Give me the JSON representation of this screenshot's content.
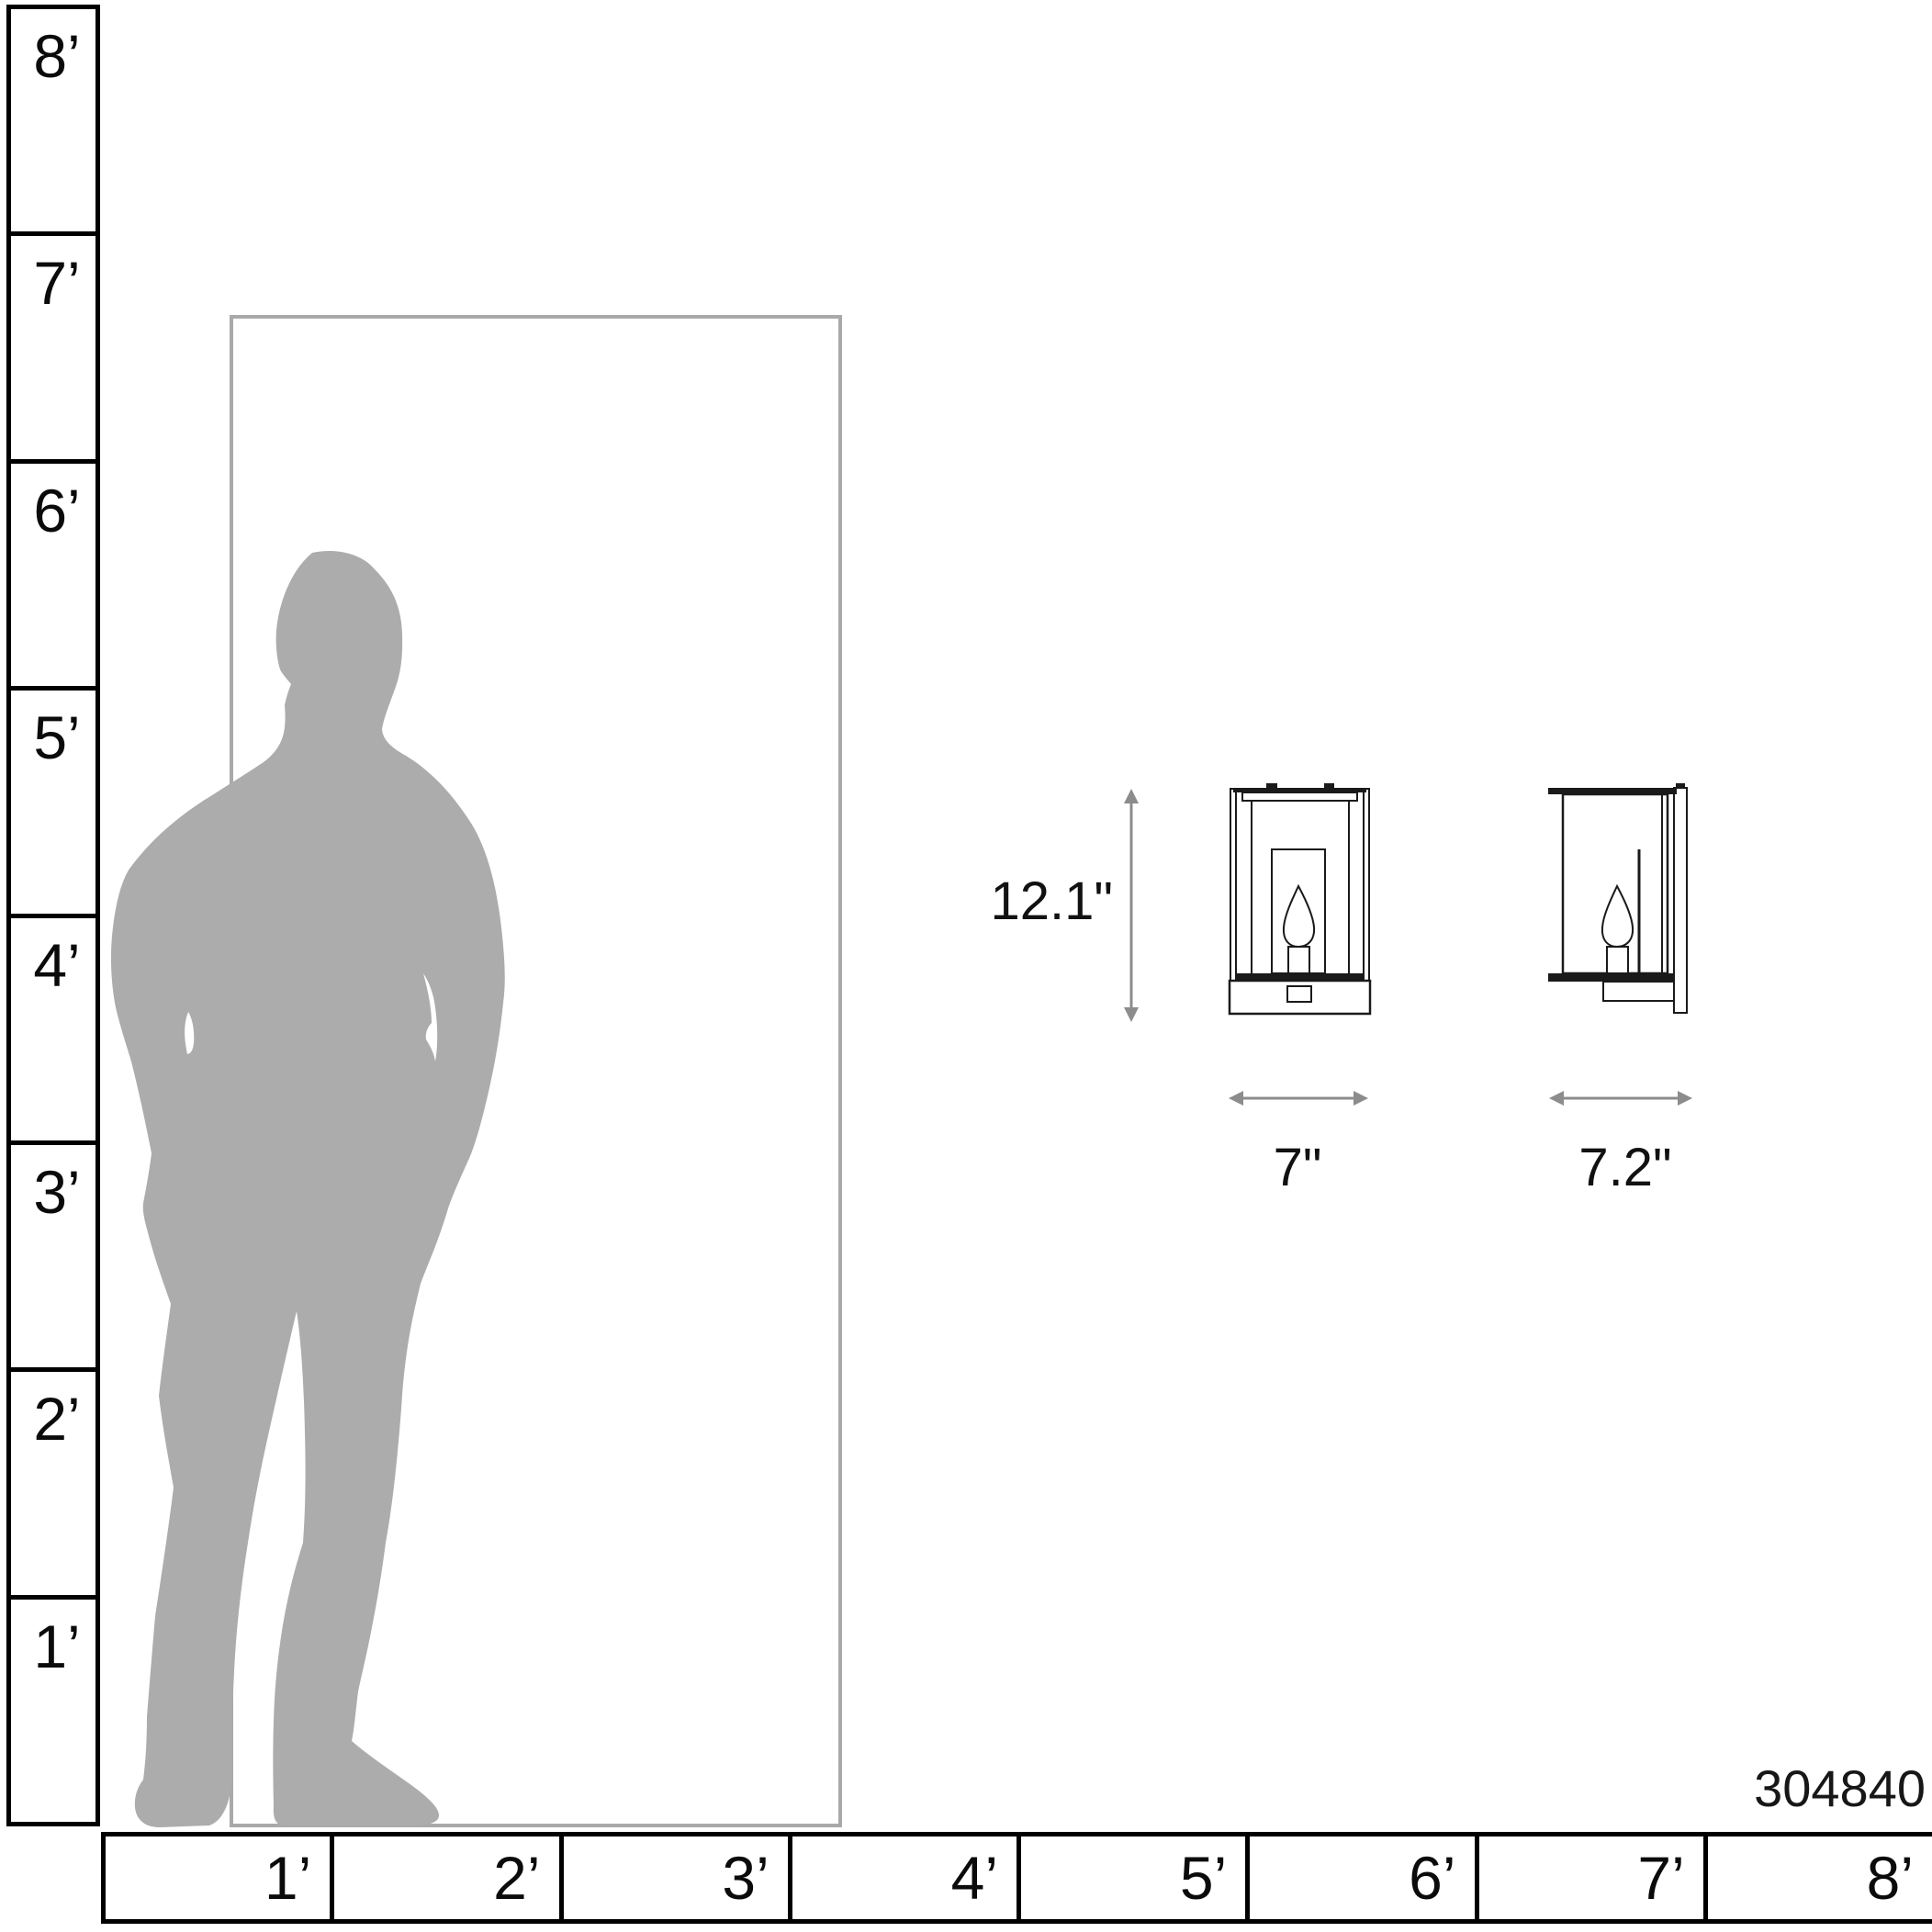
{
  "diagram": {
    "type": "product-scale-diagram",
    "product_number": "304840"
  },
  "vertical_ruler": {
    "unit": "feet",
    "labels": [
      "8’",
      "7’",
      "6’",
      "5’",
      "4’",
      "3’",
      "2’",
      "1’"
    ]
  },
  "horizontal_ruler": {
    "unit": "feet",
    "labels": [
      "1’",
      "2’",
      "3’",
      "4’",
      "5’",
      "6’",
      "7’",
      "8’"
    ]
  },
  "annotations": {
    "height_label": "12.1\"",
    "width_label": "7\"",
    "depth_label": "7.2\""
  },
  "graphics": {
    "person": "man-silhouette-for-scale",
    "door": "door-outline-for-scale",
    "lantern_front": "wall-sconce-front-view",
    "lantern_side": "wall-sconce-side-view"
  },
  "colors": {
    "silhouette": "#acacac",
    "door_outline": "#a9a9a9",
    "arrow": "#8c8c8c",
    "line": "#1a1a1a",
    "ruler_line": "#000000",
    "text": "#111111",
    "background": "#ffffff"
  }
}
